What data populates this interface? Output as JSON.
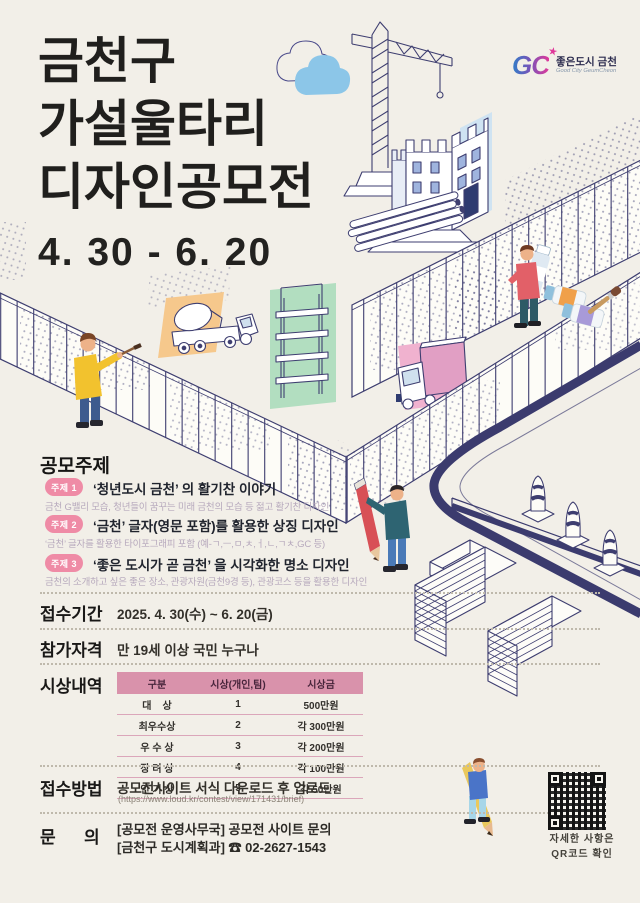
{
  "poster": {
    "title_lines": [
      "금천구",
      "가설울타리",
      "디자인공모전"
    ],
    "date_range": "4. 30 - 6. 20"
  },
  "logo": {
    "monogram": "GC",
    "star_icon": "★",
    "kr": "좋은도시 금천",
    "en": "Good City GeumCheon"
  },
  "sections": {
    "topics": {
      "label": "공모주제",
      "items": [
        {
          "badge": "주제 1",
          "title": "‘청년도시 금천’ 의 활기찬 이야기",
          "desc": "금천 G밸리 모습, 청년들이 꿈꾸는 미래 금천의 모습 등 젊고 활기찬 디자인"
        },
        {
          "badge": "주제 2",
          "title": "‘금천’ 글자(영문 포함)를 활용한 상징 디자인",
          "desc": "‘금천’ 글자를 활용한 타이포그래피 포함 (예-ㄱ,ㅡ,ㅁ,ㅊ,ㅓ,ㄴ,ㄱㅊ,GC 등)"
        },
        {
          "badge": "주제 3",
          "title": "‘좋은 도시가 곧 금천’ 을 시각화한 명소 디자인",
          "desc": "금천의 소개하고 싶은 좋은 장소, 관광자원(금천9경 등), 관광코스 등을 활용한 디자인"
        }
      ]
    },
    "period": {
      "label": "접수기간",
      "value": "2025. 4. 30(수) ~ 6. 20(금)"
    },
    "eligibility": {
      "label": "참가자격",
      "value": "만 19세 이상 국민 누구나"
    },
    "awards": {
      "label": "시상내역",
      "headers": [
        "구분",
        "시상(개인,팀)",
        "시상금"
      ],
      "rows": [
        [
          "대    상",
          "1",
          "500만원"
        ],
        [
          "최우수상",
          "2",
          "각 300만원"
        ],
        [
          "우 수 상",
          "3",
          "각 200만원"
        ],
        [
          "장 려 상",
          "4",
          "각 100만원"
        ],
        [
          "인 기 상",
          "5",
          "각 50만원"
        ]
      ]
    },
    "how": {
      "label": "접수방법",
      "line1": "공모전사이트 서식 다운로드 후 업로드",
      "line2": "(https://www.loud.kr/contest/view/171431/brief)"
    },
    "contact": {
      "label": "문      의",
      "line1": "[공모전 운영사무국] 공모전 사이트 문의",
      "line2": "[금천구 도시계획과] ☎ 02-2627-1543"
    }
  },
  "qr": {
    "note_line1": "자세한 사항은",
    "note_line2": "QR코드 확인"
  },
  "colors": {
    "background": "#f2efe8",
    "ink": "#201f1d",
    "illustration_navy": "#3e3e70",
    "badge_pink": "#ef8ba6",
    "table_header_pink": "#d992ab",
    "cloud_blue": "#8cc6e8",
    "patch_orange": "#f6c88c",
    "patch_green": "#b2dec0",
    "patch_pink": "#f0b2cf"
  }
}
